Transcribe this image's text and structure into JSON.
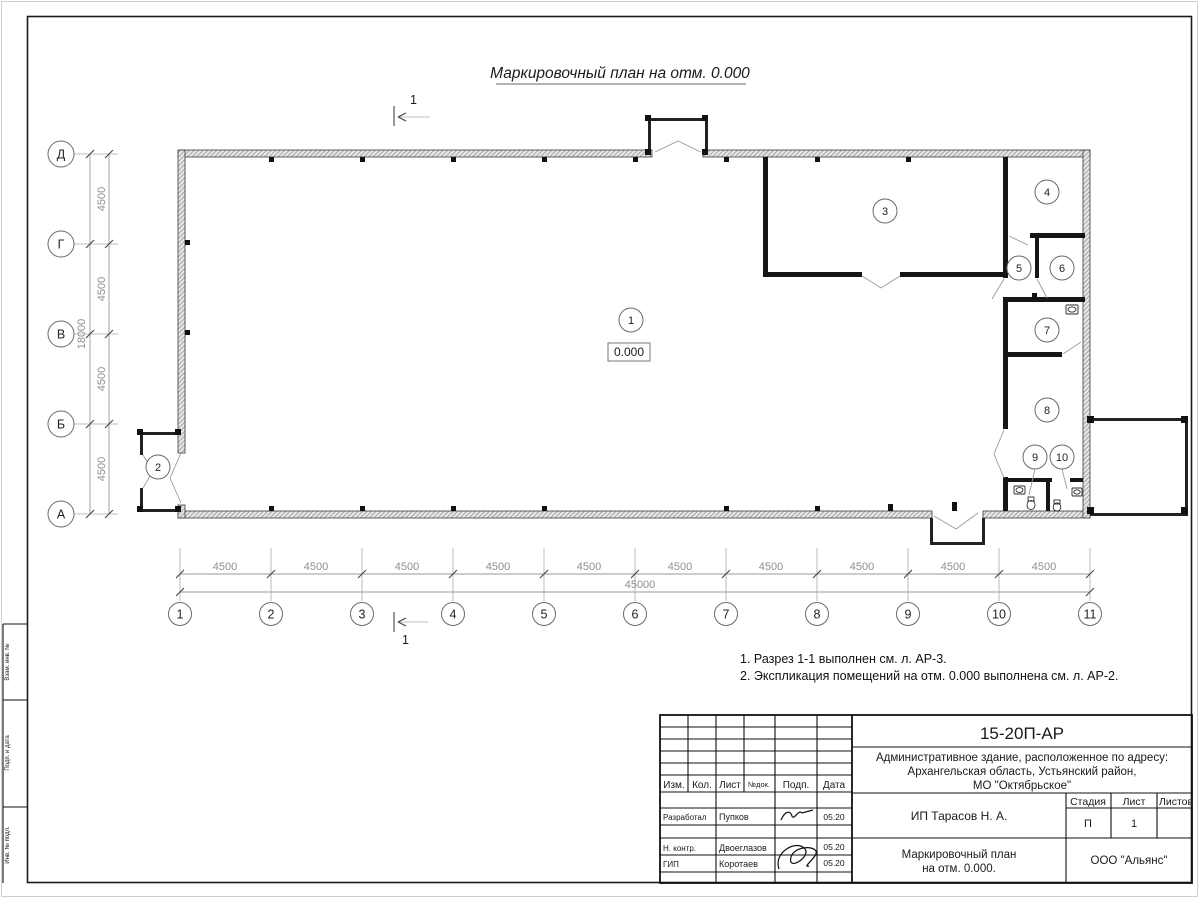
{
  "sheet": {
    "title": "Маркировочный план на отм. 0.000",
    "elevation": "0.000",
    "section_mark": "1"
  },
  "plan": {
    "rooms": [
      "1",
      "2",
      "3",
      "4",
      "5",
      "6",
      "7",
      "8",
      "9",
      "10"
    ],
    "axes_bottom": [
      "1",
      "2",
      "3",
      "4",
      "5",
      "6",
      "7",
      "8",
      "9",
      "10",
      "11"
    ],
    "axes_left": [
      "Д",
      "Г",
      "В",
      "Б",
      "А"
    ],
    "dims_bottom": [
      "4500",
      "4500",
      "4500",
      "4500",
      "4500",
      "4500",
      "4500",
      "4500",
      "4500",
      "4500"
    ],
    "dim_bottom_total": "45000",
    "dims_left": [
      "4500",
      "4500",
      "4500",
      "4500"
    ],
    "dim_left_total": "18000"
  },
  "notes": {
    "line1": "1. Разрез 1-1 выполнен см. л. АР-3.",
    "line2": "2. Экспликация помещений на отм. 0.000 выполнена см. л. АР-2."
  },
  "frame": {
    "side_labels": [
      "Взам. инв. №",
      "Подп. и дата",
      "Инв. № подл."
    ]
  },
  "titleblock": {
    "doc_number": "15-20П-АР",
    "address_line1": "Административное здание, расположенное по адресу:",
    "address_line2": "Архангельская область, Устьянский район,",
    "address_line3": "МО \"Октябрьское\"",
    "header_cols": [
      "Изм.",
      "Кол.",
      "Лист",
      "№док.",
      "Подп.",
      "Дата"
    ],
    "rows": [
      {
        "role": "Разработал",
        "name": "Пупков",
        "date": "05.20"
      },
      {
        "role": "Н. контр.",
        "name": "Двоеглазов",
        "date": "05.20"
      },
      {
        "role": "ГИП",
        "name": "Коротаев",
        "date": "05.20"
      }
    ],
    "client": "ИП Тарасов Н. А.",
    "stage_label": "Стадия",
    "sheet_label": "Лист",
    "sheets_label": "Листов",
    "stage": "П",
    "sheet_num": "1",
    "drawing_title_line1": "Маркировочный план",
    "drawing_title_line2": "на отм. 0.000.",
    "company": "ООО \"Альянс\""
  }
}
